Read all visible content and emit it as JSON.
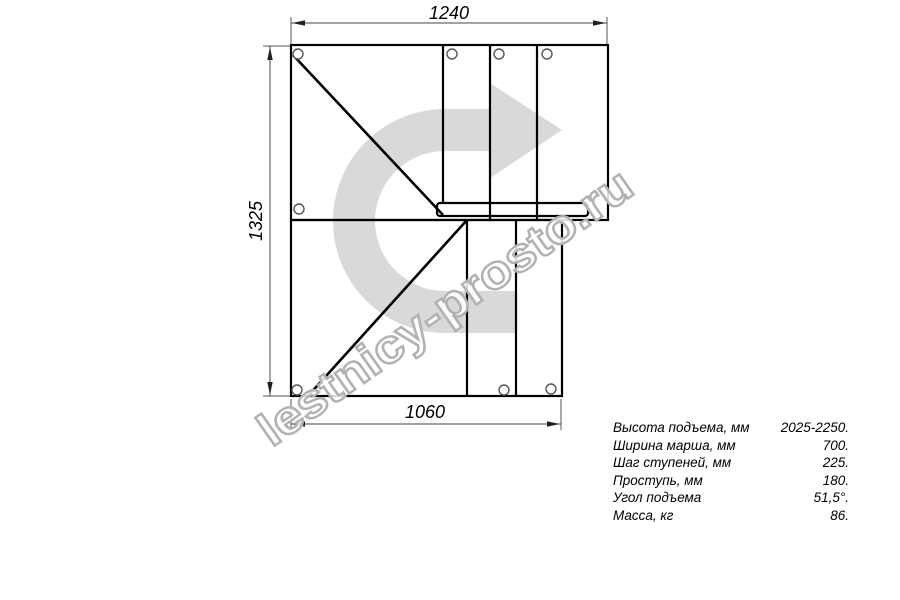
{
  "drawing": {
    "dim_top": "1240",
    "dim_left": "1325",
    "dim_bottom": "1060"
  },
  "watermark": {
    "text": "lestnicy-prosto.ru",
    "arrow_color": "#d9d9d9",
    "text_outline_color": "#b2b2b2"
  },
  "specs": {
    "rows": [
      {
        "label": "Высота подъема, мм",
        "value": "2025-2250."
      },
      {
        "label": "Ширина марша, мм",
        "value": "700."
      },
      {
        "label": "Шаг ступеней, мм",
        "value": "225."
      },
      {
        "label": "Проступь, мм",
        "value": "180."
      },
      {
        "label": "Угол подъема",
        "value": "51,5°."
      },
      {
        "label": "Масса, кг",
        "value": "86."
      }
    ]
  }
}
